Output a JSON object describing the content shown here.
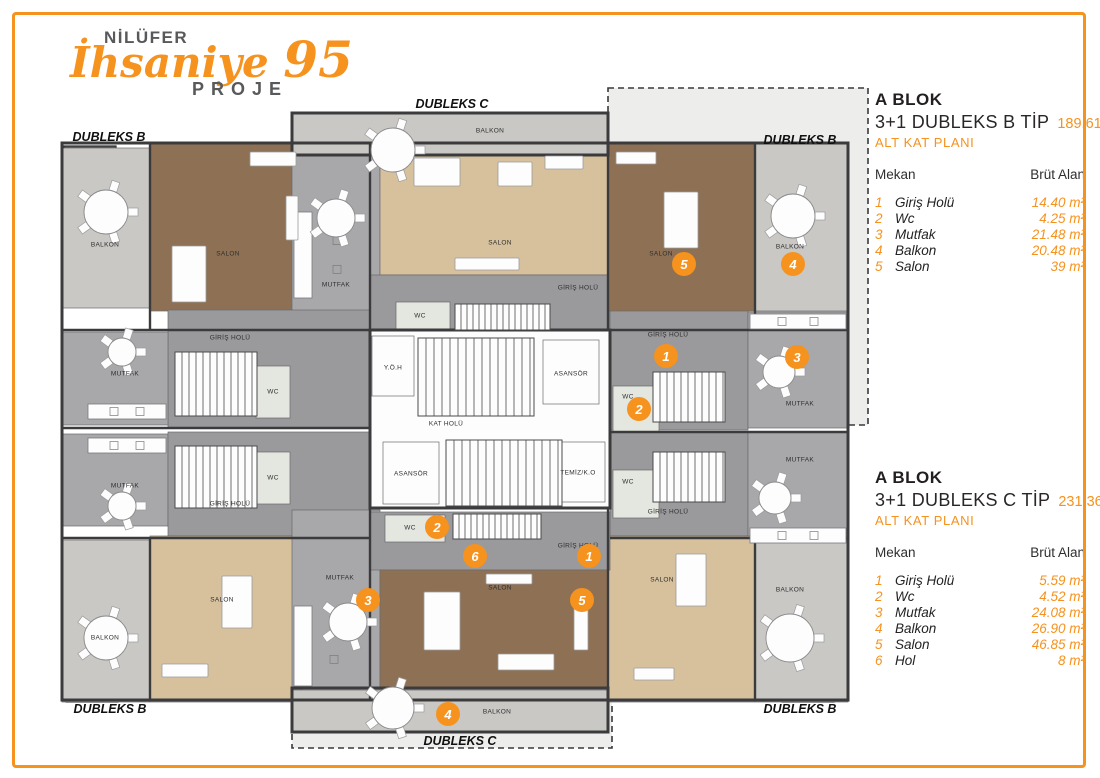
{
  "accent_color": "#f6921e",
  "logo": {
    "brand": "NİLÜFER",
    "script": "İhsaniye",
    "number": "95",
    "subtitle": "PROJE"
  },
  "panels": [
    {
      "block": "A BLOK",
      "type_label": "3+1 DUBLEKS B TİP",
      "area": "189.61m²",
      "plan_label": "ALT KAT PLANI",
      "col_room": "Mekan",
      "col_area": "Brüt Alan",
      "rows": [
        {
          "no": "1",
          "name": "Giriş Holü",
          "value": "14.40 m²"
        },
        {
          "no": "2",
          "name": "Wc",
          "value": "4.25 m²"
        },
        {
          "no": "3",
          "name": "Mutfak",
          "value": "21.48 m²"
        },
        {
          "no": "4",
          "name": "Balkon",
          "value": "20.48 m²"
        },
        {
          "no": "5",
          "name": "Salon",
          "value": "39 m²"
        }
      ]
    },
    {
      "block": "A BLOK",
      "type_label": "3+1 DUBLEKS C TİP",
      "area": "231.36 m²",
      "plan_label": "ALT KAT PLANI",
      "col_room": "Mekan",
      "col_area": "Brüt Alan",
      "rows": [
        {
          "no": "1",
          "name": "Giriş Holü",
          "value": "5.59 m²"
        },
        {
          "no": "2",
          "name": "Wc",
          "value": "4.52 m²"
        },
        {
          "no": "3",
          "name": "Mutfak",
          "value": "24.08 m²"
        },
        {
          "no": "4",
          "name": "Balkon",
          "value": "26.90 m²"
        },
        {
          "no": "5",
          "name": "Salon",
          "value": "46.85 m²"
        },
        {
          "no": "6",
          "name": "Hol",
          "value": "8 m²"
        }
      ]
    }
  ],
  "plan": {
    "colors": {
      "wall": "#3b3b3d",
      "woodDark": "#8e7155",
      "woodLight": "#d7c19d",
      "balcony": "#c9c8c4",
      "kitchen": "#a8a7a9",
      "speckle": "#9a999b",
      "white": "#fdfdfd",
      "wc": "#e4e7df",
      "orange": "#f6921e",
      "dashedFill": "#ededec",
      "dark": "#58595b"
    },
    "dashed_zones": [
      {
        "id": "dubleks-b-zone",
        "x": 608,
        "y": 88,
        "w": 260,
        "h": 337
      },
      {
        "id": "dubleks-c-zone",
        "x": 292,
        "y": 686,
        "w": 320,
        "h": 62
      }
    ],
    "dark_blocks": [
      {
        "x": 64,
        "y": 146,
        "w": 52,
        "h": 22
      },
      {
        "x": 782,
        "y": 146,
        "w": 52,
        "h": 22
      },
      {
        "x": 66,
        "y": 682,
        "w": 52,
        "h": 20
      },
      {
        "x": 782,
        "y": 682,
        "w": 52,
        "h": 20
      }
    ],
    "rooms": [
      {
        "id": "balkon-tl",
        "label": "BALKON",
        "x": 62,
        "y": 148,
        "w": 88,
        "h": 160,
        "fill": "balcony",
        "lx": 105,
        "ly": 245
      },
      {
        "id": "salon-tl",
        "label": "SALON",
        "x": 150,
        "y": 143,
        "w": 152,
        "h": 168,
        "fill": "woodDark",
        "lx": 228,
        "ly": 254
      },
      {
        "id": "mutfak-tc",
        "label": "MUTFAK",
        "x": 292,
        "y": 155,
        "w": 88,
        "h": 175,
        "fill": "kitchen",
        "lx": 336,
        "ly": 285
      },
      {
        "id": "balkon-tc",
        "label": "BALKON",
        "x": 292,
        "y": 113,
        "w": 316,
        "h": 42,
        "fill": "balcony",
        "lx": 490,
        "ly": 131
      },
      {
        "id": "salon-tc",
        "label": "SALON",
        "x": 380,
        "y": 155,
        "w": 228,
        "h": 120,
        "fill": "woodLight",
        "lx": 500,
        "ly": 243
      },
      {
        "id": "hol-tc",
        "label": "GİRİŞ HOLÜ",
        "x": 370,
        "y": 275,
        "w": 240,
        "h": 55,
        "fill": "speckle",
        "lx": 578,
        "ly": 288
      },
      {
        "id": "wc-tc",
        "label": "WC",
        "x": 396,
        "y": 302,
        "w": 54,
        "h": 28,
        "fill": "wc",
        "lx": 420,
        "ly": 316
      },
      {
        "id": "giris-tl",
        "label": "GİRİŞ HOLÜ",
        "x": 168,
        "y": 310,
        "w": 202,
        "h": 118,
        "fill": "speckle",
        "lx": 230,
        "ly": 338
      },
      {
        "id": "wc-tl",
        "label": "WC",
        "x": 256,
        "y": 366,
        "w": 34,
        "h": 52,
        "fill": "wc",
        "lx": 273,
        "ly": 392
      },
      {
        "id": "mutfak-left-top",
        "label": "MUTFAK",
        "x": 62,
        "y": 332,
        "w": 106,
        "h": 93,
        "fill": "kitchen",
        "lx": 125,
        "ly": 374
      },
      {
        "id": "mutfak-left-bot",
        "label": "MUTFAK",
        "x": 62,
        "y": 434,
        "w": 106,
        "h": 92,
        "fill": "kitchen",
        "lx": 125,
        "ly": 486
      },
      {
        "id": "giris-bl",
        "label": "GİRİŞ HOLÜ",
        "x": 168,
        "y": 432,
        "w": 202,
        "h": 104,
        "fill": "speckle",
        "lx": 230,
        "ly": 504
      },
      {
        "id": "wc-bl",
        "label": "WC",
        "x": 256,
        "y": 452,
        "w": 34,
        "h": 52,
        "fill": "wc",
        "lx": 273,
        "ly": 478
      },
      {
        "id": "balkon-bl",
        "label": "BALKON",
        "x": 62,
        "y": 540,
        "w": 88,
        "h": 162,
        "fill": "balcony",
        "lx": 105,
        "ly": 638
      },
      {
        "id": "salon-bl",
        "label": "SALON",
        "x": 150,
        "y": 536,
        "w": 152,
        "h": 166,
        "fill": "woodLight",
        "lx": 222,
        "ly": 600
      },
      {
        "id": "kat-holu",
        "label": "KAT HOLÜ",
        "x": 370,
        "y": 330,
        "w": 240,
        "h": 178,
        "fill": "white",
        "lx": 446,
        "ly": 424
      },
      {
        "id": "yoh",
        "label": "Y.Ö.H",
        "x": 372,
        "y": 336,
        "w": 42,
        "h": 60,
        "fill": "white",
        "lx": 393,
        "ly": 368
      },
      {
        "id": "asansor-top",
        "label": "ASANSÖR",
        "x": 543,
        "y": 340,
        "w": 56,
        "h": 64,
        "fill": "white",
        "lx": 571,
        "ly": 374
      },
      {
        "id": "asansor-bottom",
        "label": "ASANSÖR",
        "x": 383,
        "y": 442,
        "w": 56,
        "h": 62,
        "fill": "white",
        "lx": 411,
        "ly": 474
      },
      {
        "id": "temiz-ko",
        "label": "TEMİZ/K.O",
        "x": 551,
        "y": 442,
        "w": 54,
        "h": 60,
        "fill": "white",
        "lx": 578,
        "ly": 473
      },
      {
        "id": "giris-tr",
        "label": "GİRİŞ HOLÜ",
        "x": 610,
        "y": 310,
        "w": 138,
        "h": 120,
        "fill": "speckle",
        "lx": 668,
        "ly": 335
      },
      {
        "id": "wc-tr",
        "label": "WC",
        "x": 613,
        "y": 386,
        "w": 46,
        "h": 48,
        "fill": "wc",
        "lx": 628,
        "ly": 397
      },
      {
        "id": "mutfak-tr",
        "label": "MUTFAK",
        "x": 748,
        "y": 312,
        "w": 100,
        "h": 116,
        "fill": "kitchen",
        "lx": 800,
        "ly": 404
      },
      {
        "id": "giris-br",
        "label": "GİRİŞ HOLÜ",
        "x": 610,
        "y": 432,
        "w": 138,
        "h": 104,
        "fill": "speckle",
        "lx": 668,
        "ly": 512
      },
      {
        "id": "wc-br",
        "label": "WC",
        "x": 613,
        "y": 470,
        "w": 46,
        "h": 48,
        "fill": "wc",
        "lx": 628,
        "ly": 482
      },
      {
        "id": "mutfak-br",
        "label": "MUTFAK",
        "x": 748,
        "y": 432,
        "w": 100,
        "h": 114,
        "fill": "kitchen",
        "lx": 800,
        "ly": 460
      },
      {
        "id": "salon-tr",
        "label": "SALON",
        "x": 608,
        "y": 143,
        "w": 147,
        "h": 168,
        "fill": "woodDark",
        "lx": 661,
        "ly": 254
      },
      {
        "id": "balkon-tr",
        "label": "BALKON",
        "x": 755,
        "y": 143,
        "w": 93,
        "h": 168,
        "fill": "balcony",
        "lx": 790,
        "ly": 247
      },
      {
        "id": "salon-br",
        "label": "SALON",
        "x": 608,
        "y": 536,
        "w": 147,
        "h": 166,
        "fill": "woodLight",
        "lx": 662,
        "ly": 580
      },
      {
        "id": "balkon-br",
        "label": "BALKON",
        "x": 755,
        "y": 540,
        "w": 93,
        "h": 162,
        "fill": "balcony",
        "lx": 790,
        "ly": 590
      },
      {
        "id": "mutfak-bc",
        "label": "MUTFAK",
        "x": 292,
        "y": 510,
        "w": 88,
        "h": 178,
        "fill": "kitchen",
        "lx": 340,
        "ly": 578
      },
      {
        "id": "hol-bc",
        "label": "GİRİŞ HOLÜ",
        "x": 370,
        "y": 512,
        "w": 240,
        "h": 58,
        "fill": "speckle",
        "lx": 578,
        "ly": 546
      },
      {
        "id": "wc-bc",
        "label": "WC",
        "x": 385,
        "y": 515,
        "w": 60,
        "h": 27,
        "fill": "wc",
        "lx": 410,
        "ly": 528
      },
      {
        "id": "salon-bc",
        "label": "SALON",
        "x": 380,
        "y": 570,
        "w": 228,
        "h": 118,
        "fill": "woodDark",
        "lx": 500,
        "ly": 588
      },
      {
        "id": "balkon-bc",
        "label": "BALKON",
        "x": 292,
        "y": 690,
        "w": 316,
        "h": 42,
        "fill": "balcony",
        "lx": 497,
        "ly": 712
      }
    ],
    "walls": {
      "rects": [
        {
          "x": 62,
          "y": 143,
          "w": 786,
          "h": 557
        },
        {
          "x": 292,
          "y": 113,
          "w": 316,
          "h": 42
        },
        {
          "x": 292,
          "y": 688,
          "w": 316,
          "h": 44
        },
        {
          "x": 370,
          "y": 330,
          "w": 240,
          "h": 178
        }
      ],
      "lines": [
        [
          370,
          143,
          370,
          330
        ],
        [
          608,
          143,
          608,
          330
        ],
        [
          370,
          508,
          370,
          700
        ],
        [
          608,
          508,
          608,
          700
        ],
        [
          62,
          330,
          370,
          330
        ],
        [
          610,
          330,
          848,
          330
        ],
        [
          62,
          538,
          370,
          538
        ],
        [
          610,
          538,
          848,
          538
        ],
        [
          150,
          143,
          150,
          330
        ],
        [
          755,
          143,
          755,
          330
        ],
        [
          150,
          538,
          150,
          700
        ],
        [
          755,
          538,
          755,
          700
        ],
        [
          62,
          428,
          370,
          428
        ],
        [
          610,
          432,
          848,
          432
        ],
        [
          292,
          155,
          608,
          155
        ],
        [
          292,
          688,
          608,
          688
        ]
      ]
    },
    "stairs": [
      {
        "x": 418,
        "y": 338,
        "w": 116,
        "h": 78,
        "gap": 8
      },
      {
        "x": 446,
        "y": 440,
        "w": 116,
        "h": 66,
        "gap": 8
      },
      {
        "x": 175,
        "y": 352,
        "w": 82,
        "h": 64,
        "gap": 7
      },
      {
        "x": 175,
        "y": 446,
        "w": 82,
        "h": 62,
        "gap": 7
      },
      {
        "x": 653,
        "y": 372,
        "w": 72,
        "h": 50,
        "gap": 7
      },
      {
        "x": 653,
        "y": 452,
        "w": 72,
        "h": 50,
        "gap": 7
      },
      {
        "x": 455,
        "y": 304,
        "w": 95,
        "h": 26,
        "gap": 6
      },
      {
        "x": 453,
        "y": 514,
        "w": 88,
        "h": 25,
        "gap": 6
      }
    ],
    "counters": [
      {
        "x": 88,
        "y": 404,
        "w": 78,
        "h": 15
      },
      {
        "x": 88,
        "y": 438,
        "w": 78,
        "h": 15
      },
      {
        "x": 750,
        "y": 314,
        "w": 96,
        "h": 15
      },
      {
        "x": 750,
        "y": 528,
        "w": 96,
        "h": 15
      },
      {
        "x": 294,
        "y": 212,
        "w": 18,
        "h": 86
      },
      {
        "x": 294,
        "y": 606,
        "w": 18,
        "h": 80
      }
    ],
    "furniture": [
      {
        "x": 172,
        "y": 246,
        "w": 34,
        "h": 56
      },
      {
        "x": 250,
        "y": 152,
        "w": 46,
        "h": 14
      },
      {
        "x": 286,
        "y": 196,
        "w": 12,
        "h": 44
      },
      {
        "x": 414,
        "y": 158,
        "w": 46,
        "h": 28
      },
      {
        "x": 498,
        "y": 162,
        "w": 34,
        "h": 24
      },
      {
        "x": 545,
        "y": 156,
        "w": 38,
        "h": 13
      },
      {
        "x": 455,
        "y": 258,
        "w": 64,
        "h": 12
      },
      {
        "x": 664,
        "y": 192,
        "w": 34,
        "h": 56
      },
      {
        "x": 616,
        "y": 152,
        "w": 40,
        "h": 12
      },
      {
        "x": 424,
        "y": 592,
        "w": 36,
        "h": 58
      },
      {
        "x": 498,
        "y": 654,
        "w": 56,
        "h": 16
      },
      {
        "x": 574,
        "y": 606,
        "w": 14,
        "h": 44
      },
      {
        "x": 486,
        "y": 574,
        "w": 46,
        "h": 10
      },
      {
        "x": 222,
        "y": 576,
        "w": 30,
        "h": 52
      },
      {
        "x": 162,
        "y": 664,
        "w": 46,
        "h": 13
      },
      {
        "x": 676,
        "y": 554,
        "w": 30,
        "h": 52
      },
      {
        "x": 634,
        "y": 668,
        "w": 40,
        "h": 12
      }
    ],
    "round_tables": [
      {
        "cx": 106,
        "cy": 212,
        "r": 22
      },
      {
        "cx": 793,
        "cy": 216,
        "r": 22
      },
      {
        "cx": 106,
        "cy": 638,
        "r": 22
      },
      {
        "cx": 790,
        "cy": 638,
        "r": 24
      },
      {
        "cx": 393,
        "cy": 150,
        "r": 22
      },
      {
        "cx": 393,
        "cy": 708,
        "r": 21
      },
      {
        "cx": 336,
        "cy": 218,
        "r": 19
      },
      {
        "cx": 348,
        "cy": 622,
        "r": 19
      },
      {
        "cx": 779,
        "cy": 372,
        "r": 16
      },
      {
        "cx": 775,
        "cy": 498,
        "r": 16
      },
      {
        "cx": 122,
        "cy": 352,
        "r": 14
      },
      {
        "cx": 122,
        "cy": 506,
        "r": 14
      }
    ],
    "markers": [
      {
        "n": "5",
        "x": 684,
        "y": 264
      },
      {
        "n": "4",
        "x": 793,
        "y": 264
      },
      {
        "n": "1",
        "x": 666,
        "y": 356
      },
      {
        "n": "2",
        "x": 639,
        "y": 409
      },
      {
        "n": "3",
        "x": 797,
        "y": 357
      },
      {
        "n": "2",
        "x": 437,
        "y": 527
      },
      {
        "n": "6",
        "x": 475,
        "y": 556
      },
      {
        "n": "1",
        "x": 589,
        "y": 556
      },
      {
        "n": "3",
        "x": 368,
        "y": 600
      },
      {
        "n": "5",
        "x": 582,
        "y": 600
      },
      {
        "n": "4",
        "x": 448,
        "y": 714
      }
    ],
    "zone_labels": [
      {
        "text": "DUBLEKS B",
        "x": 109,
        "y": 141
      },
      {
        "text": "DUBLEKS B",
        "x": 800,
        "y": 144
      },
      {
        "text": "DUBLEKS B",
        "x": 110,
        "y": 713
      },
      {
        "text": "DUBLEKS B",
        "x": 800,
        "y": 713
      },
      {
        "text": "DUBLEKS C",
        "x": 452,
        "y": 108
      },
      {
        "text": "DUBLEKS C",
        "x": 460,
        "y": 745
      }
    ]
  }
}
